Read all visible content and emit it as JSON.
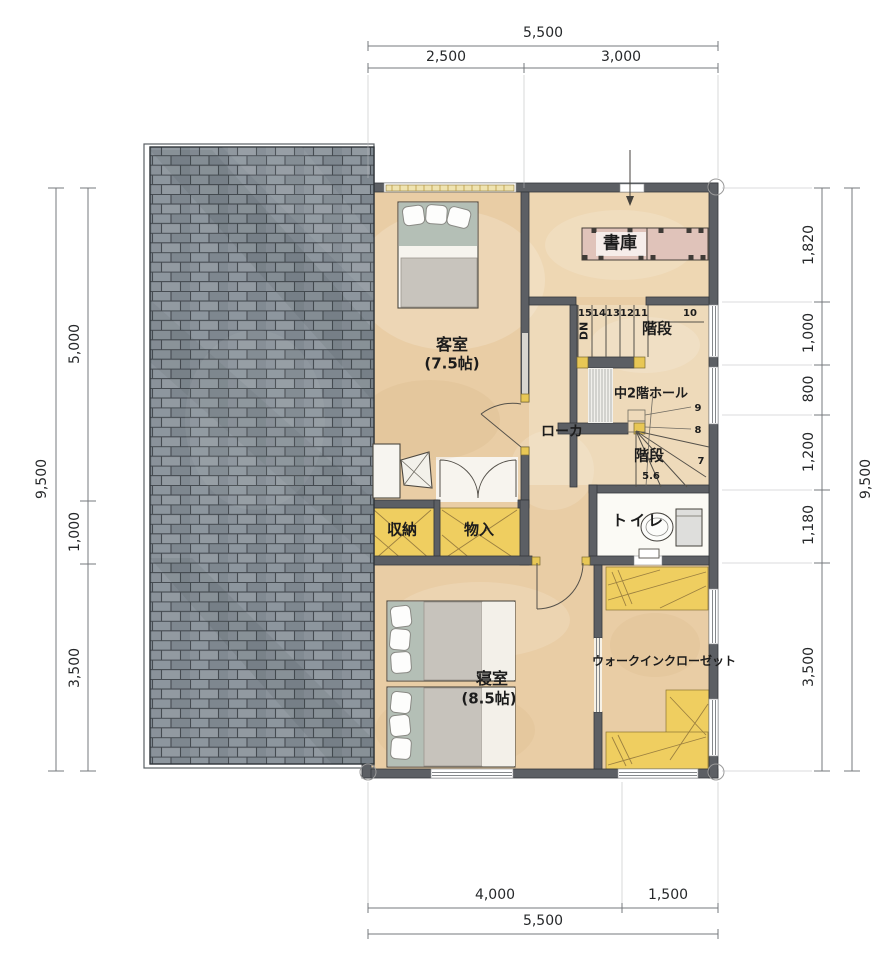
{
  "labels": {
    "guest_room": "客室",
    "guest_room_size": "(7.5帖)",
    "library": "書庫",
    "stairs_upper": "階段",
    "stairs_lower": "階段",
    "mezzanine_hall": "中2階ホール",
    "corridor": "ローカ",
    "storage": "収納",
    "closet": "物入",
    "toilet": "トイレ",
    "bedroom": "寝室",
    "bedroom_size": "(8.5帖)",
    "walk_in_closet": "ウォークインクローゼット",
    "down": "DN"
  },
  "stair_numbers": {
    "s15": "15",
    "s14": "14",
    "s13": "13",
    "s12": "12",
    "s11": "11",
    "s10": "10",
    "s9": "9",
    "s8": "8",
    "s7": "7",
    "s56": "5.6"
  },
  "dimensions": {
    "top": {
      "overall": "5,500",
      "seg1": "2,500",
      "seg2": "3,000"
    },
    "bottom": {
      "overall": "5,500",
      "seg1": "4,000",
      "seg2": "1,500"
    },
    "left": {
      "overall": "9,500",
      "seg1": "5,000",
      "seg2": "1,000",
      "seg3": "3,500"
    },
    "right": {
      "overall": "9,500",
      "seg1": "1,820",
      "seg2": "1,000",
      "seg3": "800",
      "seg4": "1,200",
      "seg5": "1,180",
      "seg6": "3,500"
    }
  },
  "colors": {
    "wall": "#5c5f64",
    "floor": "#e9cda5",
    "floor-light": "#efdaba",
    "closet-yellow": "#efce60",
    "shelf-pink": "#e0c3ba",
    "roof-tile": "#87909a",
    "roof-joint": "#464c52",
    "dim-line": "#76797c",
    "ink": "#1c1c1c"
  }
}
